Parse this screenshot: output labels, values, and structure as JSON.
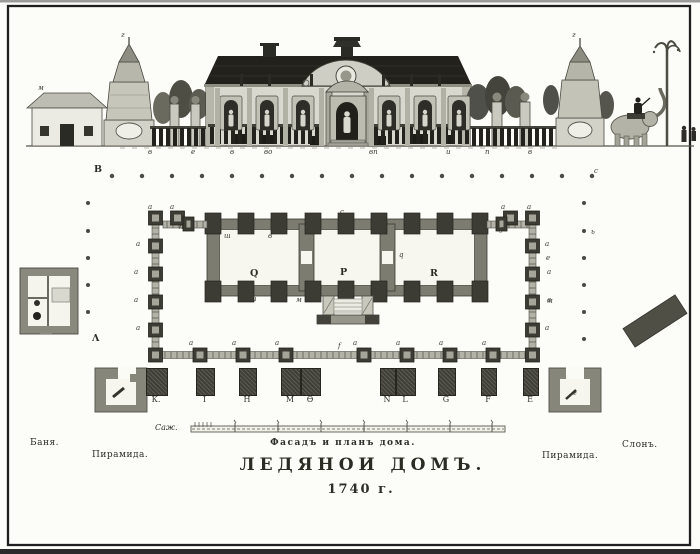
{
  "plate": {
    "title": "ЛЕДЯНОИ ДОМЪ.",
    "year": "1740 г.",
    "caption": "Фасадъ и планъ дома.",
    "scale_label": "Саж."
  },
  "side_labels": {
    "bath": "Баня.",
    "pyramid_left": "Пирамида.",
    "pyramid_right": "Пирамида.",
    "elephant": "Слонъ."
  },
  "cannons": [
    {
      "label": "К.",
      "x": 146,
      "w": 20
    },
    {
      "label": "I",
      "x": 196,
      "w": 17
    },
    {
      "label": "Н",
      "x": 239,
      "w": 16
    },
    {
      "label": "М",
      "x": 281,
      "w": 18
    },
    {
      "label": "Ѳ",
      "x": 301,
      "w": 18
    },
    {
      "label": "N",
      "x": 380,
      "w": 14
    },
    {
      "label": "L",
      "x": 396,
      "w": 18
    },
    {
      "label": "G",
      "x": 438,
      "w": 16
    },
    {
      "label": "F",
      "x": 481,
      "w": 14
    },
    {
      "label": "Е",
      "x": 523,
      "w": 14
    }
  ],
  "plan_letters": [
    {
      "t": "B",
      "x": 94,
      "y": 165,
      "lg": 1
    },
    {
      "t": "c",
      "x": 594,
      "y": 168
    },
    {
      "t": "Λ",
      "x": 92,
      "y": 334,
      "lg": 1
    },
    {
      "t": "c",
      "x": 340,
      "y": 209
    },
    {
      "t": "h",
      "x": 179,
      "y": 224
    },
    {
      "t": "g",
      "x": 499,
      "y": 226
    },
    {
      "t": "ш",
      "x": 224,
      "y": 233
    },
    {
      "t": "в",
      "x": 268,
      "y": 233
    },
    {
      "t": "q",
      "x": 399,
      "y": 252
    },
    {
      "t": "Q",
      "x": 250,
      "y": 269,
      "lg": 1
    },
    {
      "t": "P",
      "x": 340,
      "y": 268,
      "lg": 1
    },
    {
      "t": "R",
      "x": 430,
      "y": 269,
      "lg": 1
    },
    {
      "t": "b",
      "x": 340,
      "y": 287
    },
    {
      "t": "и",
      "x": 252,
      "y": 296
    },
    {
      "t": "м",
      "x": 296,
      "y": 297
    },
    {
      "t": "f",
      "x": 338,
      "y": 343
    },
    {
      "t": "ь",
      "x": 591,
      "y": 229
    },
    {
      "t": "е",
      "x": 546,
      "y": 255
    },
    {
      "t": "м",
      "x": 547,
      "y": 298
    },
    {
      "t": "г",
      "x": 573,
      "y": 390
    }
  ],
  "fence_letter": {
    "glyph": "а",
    "positions": [
      [
        148,
        204
      ],
      [
        170,
        204
      ],
      [
        501,
        204
      ],
      [
        527,
        204
      ],
      [
        136,
        241
      ],
      [
        134,
        269
      ],
      [
        134,
        297
      ],
      [
        136,
        325
      ],
      [
        545,
        241
      ],
      [
        547,
        269
      ],
      [
        547,
        297
      ],
      [
        545,
        325
      ],
      [
        189,
        340
      ],
      [
        232,
        340
      ],
      [
        275,
        340
      ],
      [
        353,
        340
      ],
      [
        396,
        340
      ],
      [
        439,
        340
      ],
      [
        482,
        340
      ]
    ]
  },
  "facade_letters": [
    {
      "t": "м",
      "x": 38,
      "y": 85
    },
    {
      "t": "г",
      "x": 121,
      "y": 32
    },
    {
      "t": "г",
      "x": 572,
      "y": 32
    },
    {
      "t": "в",
      "x": 148,
      "y": 149
    },
    {
      "t": "е",
      "x": 191,
      "y": 149
    },
    {
      "t": "в",
      "x": 230,
      "y": 149
    },
    {
      "t": "во",
      "x": 264,
      "y": 149
    },
    {
      "t": "вп",
      "x": 369,
      "y": 149
    },
    {
      "t": "и",
      "x": 446,
      "y": 149
    },
    {
      "t": "п",
      "x": 485,
      "y": 149
    },
    {
      "t": "в",
      "x": 528,
      "y": 149
    }
  ]
}
